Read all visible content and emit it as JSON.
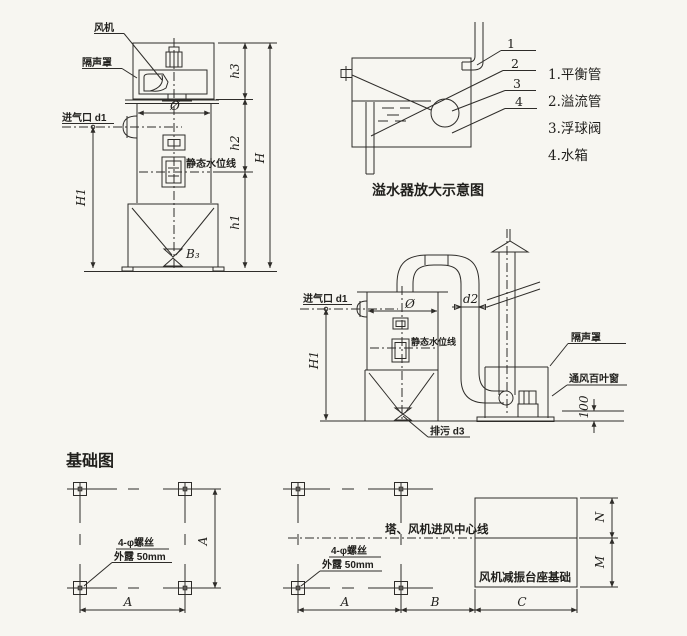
{
  "colors": {
    "ink": "#2e2c29",
    "paper": "#f7f6f1"
  },
  "tower_front": {
    "fan_label": "风机",
    "enclosure_label": "隔声罩",
    "inlet_label": "进气口 d1",
    "water_line_label": "静态水位线",
    "hopper_label": "B₃",
    "diameter_label": "Ø",
    "dim_h3": "h3",
    "dim_h2": "h2",
    "dim_h1": "h1",
    "dim_H": "H",
    "dim_H1": "H1"
  },
  "overflow_detail": {
    "caption": "溢水器放大示意图",
    "callout_1": "1",
    "callout_2": "2",
    "callout_3": "3",
    "callout_4": "4",
    "legend": [
      "1.平衡管",
      "2.溢流管",
      "3.浮球阀",
      "4.水箱"
    ]
  },
  "tower_side": {
    "inlet_label": "进气口 d1",
    "diameter_label": "Ø",
    "duct_dim": "d2",
    "water_line_label": "静态水位线",
    "dim_H1": "H1",
    "enclosure_label": "隔声罩",
    "louver_label": "通风百叶窗",
    "ground_clearance": "100",
    "drain_label": "排污 d3"
  },
  "foundation": {
    "heading": "基础图",
    "left_plan": {
      "bolt_note_line1": "4-φ螺丝",
      "bolt_note_line2": "外露 50mm",
      "dim_width": "A",
      "dim_depth": "A"
    },
    "right_plan": {
      "centerline_label": "塔、风机进风中心线",
      "bolt_note_line1": "4-φ螺丝",
      "bolt_note_line2": "外露 50mm",
      "pedestal_label": "风机减振台座基础",
      "dim_a": "A",
      "dim_b": "B",
      "dim_c": "C",
      "dim_n": "N",
      "dim_m": "M"
    }
  }
}
